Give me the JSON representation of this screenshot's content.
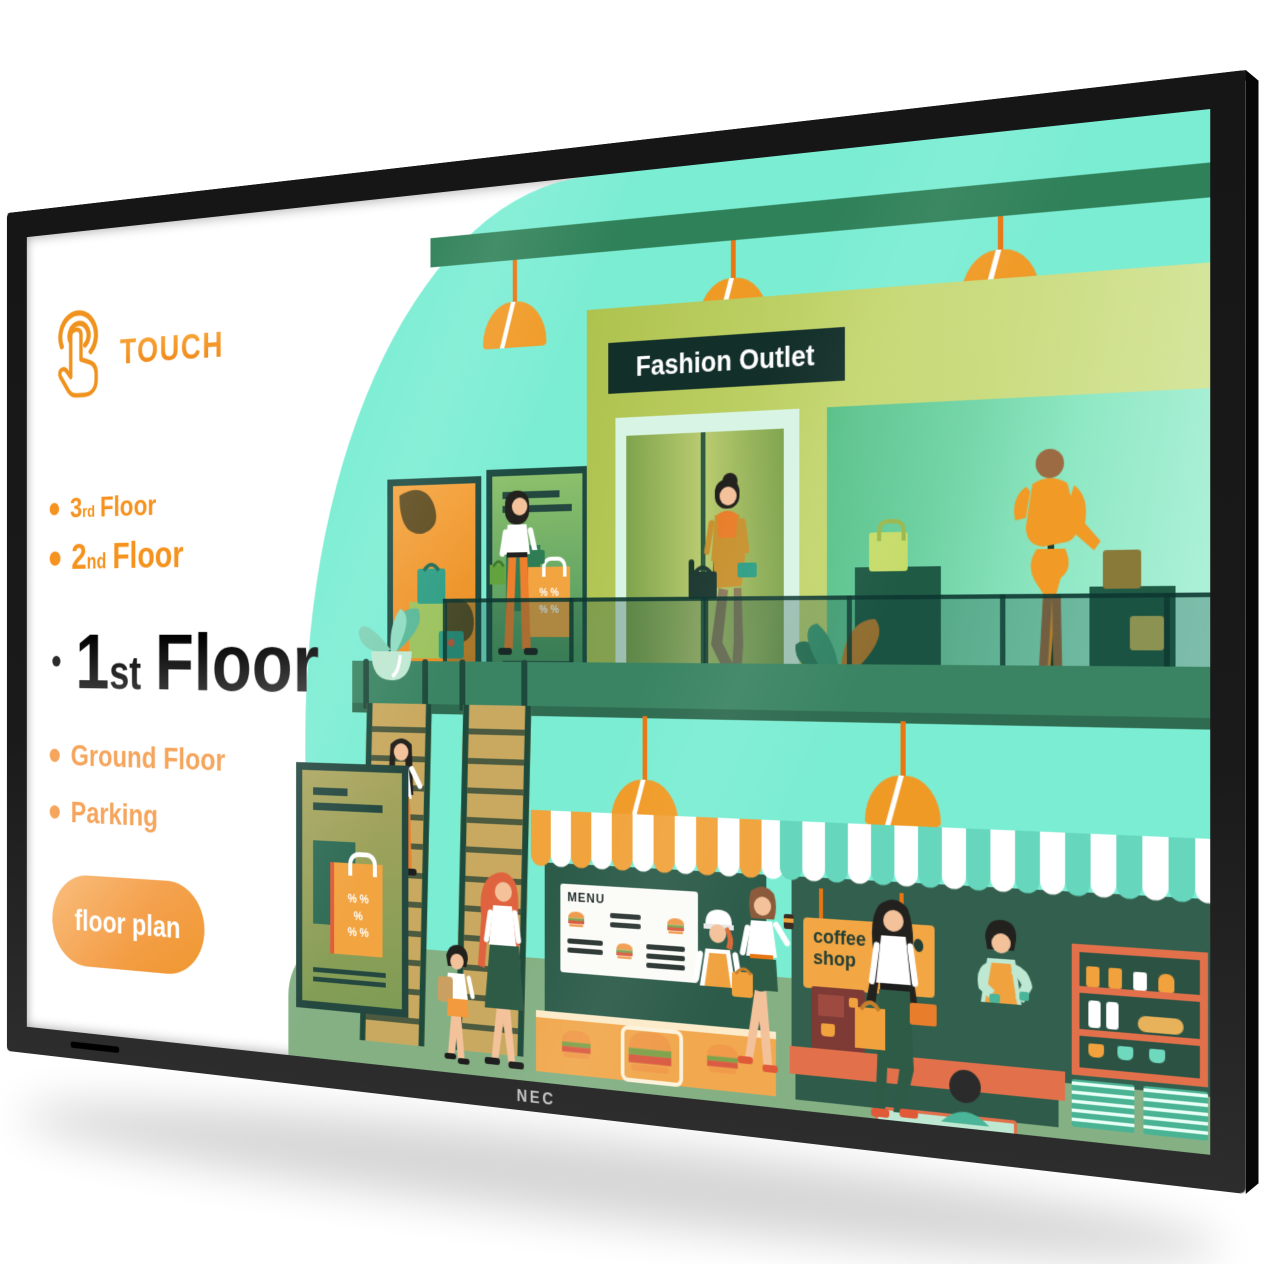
{
  "device": {
    "brand": "NEC"
  },
  "ui": {
    "touch_label": "TOUCH",
    "menu": {
      "floors": [
        {
          "num": "3",
          "suffix": "rd",
          "word": "Floor"
        },
        {
          "num": "2",
          "suffix": "nd",
          "word": "Floor"
        },
        {
          "num": "1",
          "suffix": "st",
          "word": "Floor"
        },
        {
          "label": "Ground Floor"
        },
        {
          "label": "Parking"
        }
      ],
      "action_button": "floor plan"
    }
  },
  "illustration": {
    "fashion_outlet_sign": "Fashion Outlet",
    "menu_board_title": "MENU",
    "coffee_shop_sign": "coffee shop",
    "discount_rows": [
      "% %",
      "%",
      "% %"
    ]
  },
  "colors": {
    "accent_orange": "#F2921D",
    "light_orange": "#F5A55C",
    "mint": "#7BEDD3",
    "sign_green": "#13302B",
    "bezel": "#1A1A1A",
    "ground_green": "#84B084"
  }
}
